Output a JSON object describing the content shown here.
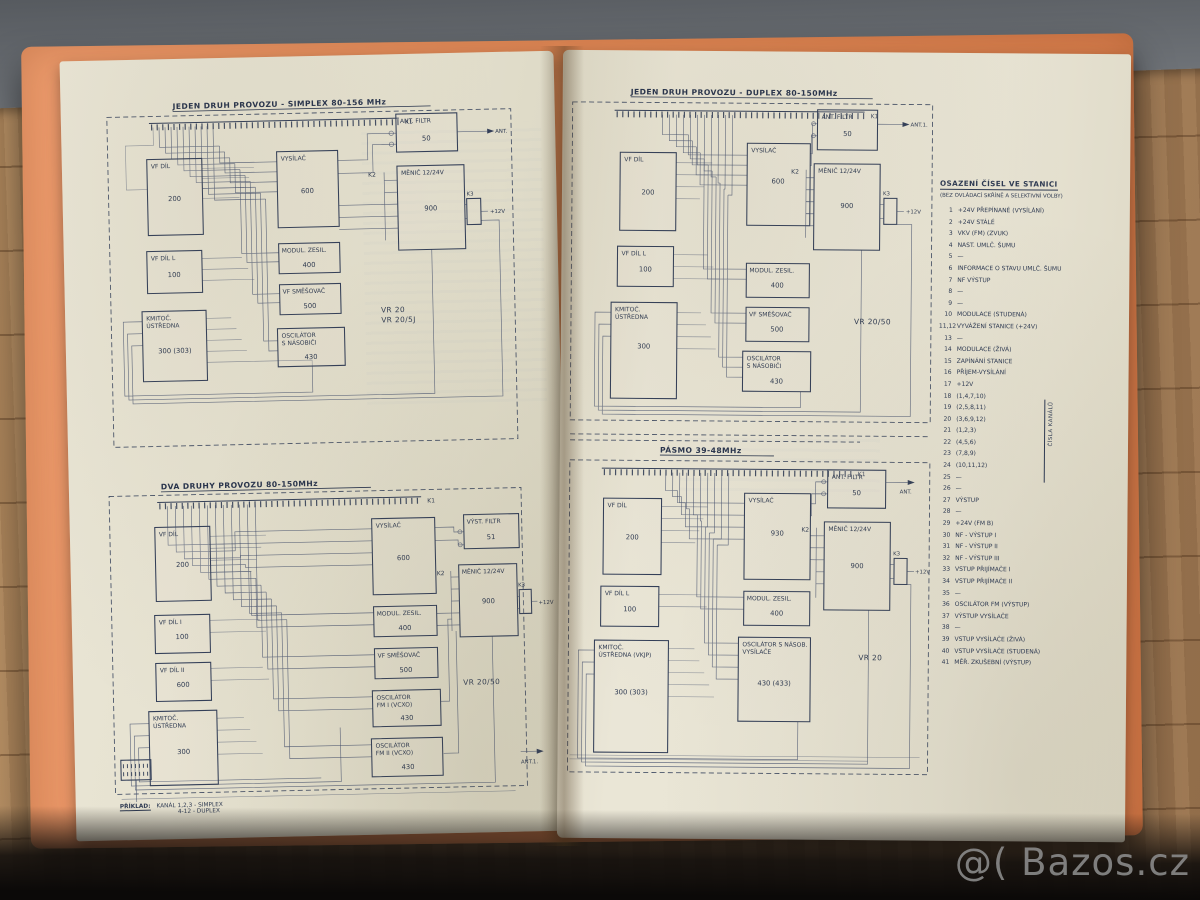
{
  "watermark": "@( Bazos.cz",
  "left_page": {
    "top": {
      "title": "JEDEN DRUH PROVOZU - SIMPLEX  80-156 MHz",
      "k1": "K1",
      "k2": "K2",
      "k3": "K3",
      "ant": "ANT.",
      "v12": "+12V",
      "variant1": "VR 20",
      "variant2": "VR 20/5J",
      "blocks": {
        "vf_dil": {
          "l1": "VF DÍL",
          "num": "200"
        },
        "vf_dil_l": {
          "l1": "VF DÍL L",
          "num": "100"
        },
        "ustredna": {
          "l1": "KMITOČ.",
          "l2": "ÚSTŘEDNA",
          "num": "300 (303)"
        },
        "vysilac": {
          "l1": "VYSÍLAČ",
          "num": "600"
        },
        "modul": {
          "l1": "MODUL. ZESIL.",
          "num": "400"
        },
        "smesovac": {
          "l1": "VF SMĚŠOVAČ",
          "num": "500"
        },
        "oscilator": {
          "l1": "OSCILÁTOR",
          "l2": "S NÁSOBIČI",
          "num": "430"
        },
        "ant_filtr": {
          "l1": "ANT. FILTR",
          "num": "50"
        },
        "menic": {
          "l1": "MĚNIČ 12/24V",
          "num": "900"
        }
      }
    },
    "bottom": {
      "title": "DVA DRUHY PROVOZU 80-150MHz",
      "k1": "K1",
      "k2": "K2",
      "k3": "K3",
      "ant1": "ANT.1.",
      "v12": "+12V",
      "variant1": "VR 20/50",
      "blocks": {
        "vf_dil": {
          "l1": "VF DÍL",
          "num": "200"
        },
        "vf_dil_1": {
          "l1": "VF DÍL I",
          "num": "100"
        },
        "vf_dil_2": {
          "l1": "VF DÍL II",
          "num": "600"
        },
        "ustredna": {
          "l1": "KMITOČ.",
          "l2": "ÚSTŘEDNA",
          "num": "300"
        },
        "vysilac": {
          "l1": "VYSÍLAČ",
          "num": "600"
        },
        "modul": {
          "l1": "MODUL. ZESIL.",
          "num": "400"
        },
        "smesovac": {
          "l1": "VF SMĚŠOVAČ",
          "num": "500"
        },
        "osc1": {
          "l1": "OSCILÁTOR",
          "l2": "FM I (VCXO)",
          "num": "430"
        },
        "osc2": {
          "l1": "OSCILÁTOR",
          "l2": "FM II (VCXO)",
          "num": "430"
        },
        "vyst_filtr": {
          "l1": "VÝST. FILTR",
          "num": "51"
        },
        "menic": {
          "l1": "MĚNIČ 12/24V",
          "num": "900"
        }
      },
      "note_label": "PŘÍKLAD:",
      "note_line1": "KANÁL 1,2,3 - SIMPLEX",
      "note_line2": "4-12 - DUPLEX"
    }
  },
  "right_page": {
    "top": {
      "title": "JEDEN DRUH PROVOZU - DUPLEX  80-150MHz",
      "k1": "K1",
      "k2": "K2",
      "k3": "K3",
      "ant1": "ANT.1.",
      "v12": "+12V",
      "variant1": "VR 20/50",
      "blocks": {
        "vf_dil": {
          "l1": "VF DÍL",
          "num": "200"
        },
        "vf_dil_l": {
          "l1": "VF DÍL L",
          "num": "100"
        },
        "ustredna": {
          "l1": "KMITOČ.",
          "l2": "ÚSTŘEDNA",
          "num": "300"
        },
        "vysilac": {
          "l1": "VYSÍLAČ",
          "num": "600"
        },
        "modul": {
          "l1": "MODUL. ZESIL.",
          "num": "400"
        },
        "smesovac": {
          "l1": "VF SMĚŠOVAČ",
          "num": "500"
        },
        "oscilator": {
          "l1": "OSCILÁTOR",
          "l2": "S NÁSOBIČI",
          "num": "430"
        },
        "ant_filtr": {
          "l1": "ANT. FILTR",
          "num": "50"
        },
        "menic": {
          "l1": "MĚNIČ 12/24V",
          "num": "900"
        }
      }
    },
    "bottom": {
      "title": "PÁSMO 39-48MHz",
      "k1": "K1",
      "k2": "K2",
      "k3": "K3",
      "ant": "ANT.",
      "v12": "+12V",
      "variant1": "VR 20",
      "blocks": {
        "vf_dil": {
          "l1": "VF DÍL",
          "num": "200"
        },
        "vf_dil_l": {
          "l1": "VF DÍL L",
          "num": "100"
        },
        "ustredna": {
          "l1": "KMITOČ.",
          "l2": "ÚSTŘEDNA (VKJP)",
          "num": "300 (303)"
        },
        "vysilac": {
          "l1": "VYSÍLAČ",
          "num": "930"
        },
        "modul": {
          "l1": "MODUL. ZESIL.",
          "num": "400"
        },
        "osc_vys": {
          "l1": "OSCILÁTOR S NÁSOB.",
          "l2": "VYSÍLAČE",
          "num": "430 (433)"
        },
        "ant_filtr": {
          "l1": "ANT. FILTR",
          "num": "50"
        },
        "menic": {
          "l1": "MĚNIČ 12/24V",
          "num": "900"
        }
      }
    },
    "legend": {
      "title": "OSAZENÍ ČÍSEL VE STANICI",
      "subtitle": "(BEZ OVLÁDACÍ SKŘÍNĚ A SELEKTIVNÍ VOLBY)",
      "bracket_label": "ČÍSLA KANÁLŮ",
      "items": [
        {
          "n": "1",
          "t": "+24V PŘEPÍNANÉ (VYSÍLÁNÍ)"
        },
        {
          "n": "2",
          "t": "+24V STÁLÉ"
        },
        {
          "n": "3",
          "t": "VKV (FM) (ZVUK)"
        },
        {
          "n": "4",
          "t": "NAST. UMLČ. ŠUMU"
        },
        {
          "n": "5",
          "t": "—"
        },
        {
          "n": "6",
          "t": "INFORMACE O STAVU UMLČ. ŠUMU"
        },
        {
          "n": "7",
          "t": "NF VÝSTUP"
        },
        {
          "n": "8",
          "t": "—"
        },
        {
          "n": "9",
          "t": "—"
        },
        {
          "n": "10",
          "t": "MODULACE (STUDENÁ)"
        },
        {
          "n": "11,12",
          "t": "VYVÁŽENÍ STANICE (+24V)"
        },
        {
          "n": "13",
          "t": "—"
        },
        {
          "n": "14",
          "t": "MODULACE (ŽIVÁ)"
        },
        {
          "n": "15",
          "t": "ZAPÍNÁNÍ STANICE"
        },
        {
          "n": "16",
          "t": "PŘÍJEM-VYSÍLÁNÍ"
        },
        {
          "n": "17",
          "t": "+12V"
        },
        {
          "n": "18",
          "t": "(1,4,7,10)"
        },
        {
          "n": "19",
          "t": "(2,5,8,11)"
        },
        {
          "n": "20",
          "t": "(3,6,9,12)"
        },
        {
          "n": "21",
          "t": "(1,2,3)"
        },
        {
          "n": "22",
          "t": "(4,5,6)"
        },
        {
          "n": "23",
          "t": "(7,8,9)"
        },
        {
          "n": "24",
          "t": "(10,11,12)"
        },
        {
          "n": "25",
          "t": "—"
        },
        {
          "n": "26",
          "t": "—"
        },
        {
          "n": "27",
          "t": "VÝSTUP"
        },
        {
          "n": "28",
          "t": "—"
        },
        {
          "n": "29",
          "t": "+24V (FM B)"
        },
        {
          "n": "30",
          "t": "NF - VÝSTUP I"
        },
        {
          "n": "31",
          "t": "NF - VÝSTUP II"
        },
        {
          "n": "32",
          "t": "NF - VÝSTUP III"
        },
        {
          "n": "33",
          "t": "VSTUP PŘIJÍMAČE I"
        },
        {
          "n": "34",
          "t": "VSTUP PŘIJÍMAČE II"
        },
        {
          "n": "35",
          "t": "—"
        },
        {
          "n": "36",
          "t": "OSCILÁTOR FM (VÝSTUP)"
        },
        {
          "n": "37",
          "t": "VÝSTUP VYSÍLAČE"
        },
        {
          "n": "38",
          "t": "—"
        },
        {
          "n": "39",
          "t": "VSTUP VYSÍLAČE (ŽIVÁ)"
        },
        {
          "n": "40",
          "t": "VSTUP VYSÍLAČE (STUDENÁ)"
        },
        {
          "n": "41",
          "t": "MĚŘ. ZKUŠEBNÍ (VÝSTUP)"
        }
      ]
    }
  }
}
